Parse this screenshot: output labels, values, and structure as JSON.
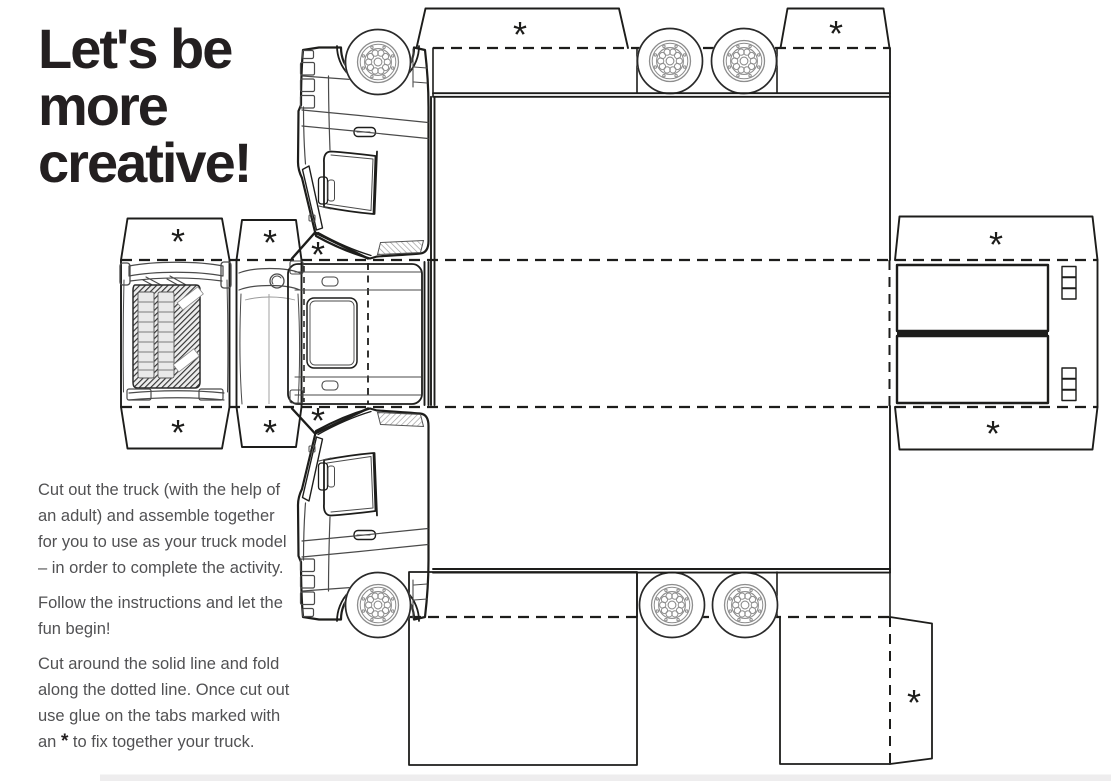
{
  "page": {
    "title_lines": [
      "Let's be",
      "more",
      "creative!"
    ],
    "instructions": {
      "p1": "Cut out the truck (with the help of an adult) and assemble together for you to use as your truck model – in order to complete the activity.",
      "p2": "Follow the instructions and let the fun begin!",
      "p3_before": "Cut around the solid line and fold along the dotted line. Once cut out use glue on the tabs marked with an ",
      "p3_star": "*",
      "p3_after": " to fix together your truck."
    },
    "colors": {
      "ink": "#231f20",
      "body_text": "#515153",
      "rim_gray": "#8d8d8d"
    }
  },
  "template": {
    "tab_marker": "*"
  }
}
